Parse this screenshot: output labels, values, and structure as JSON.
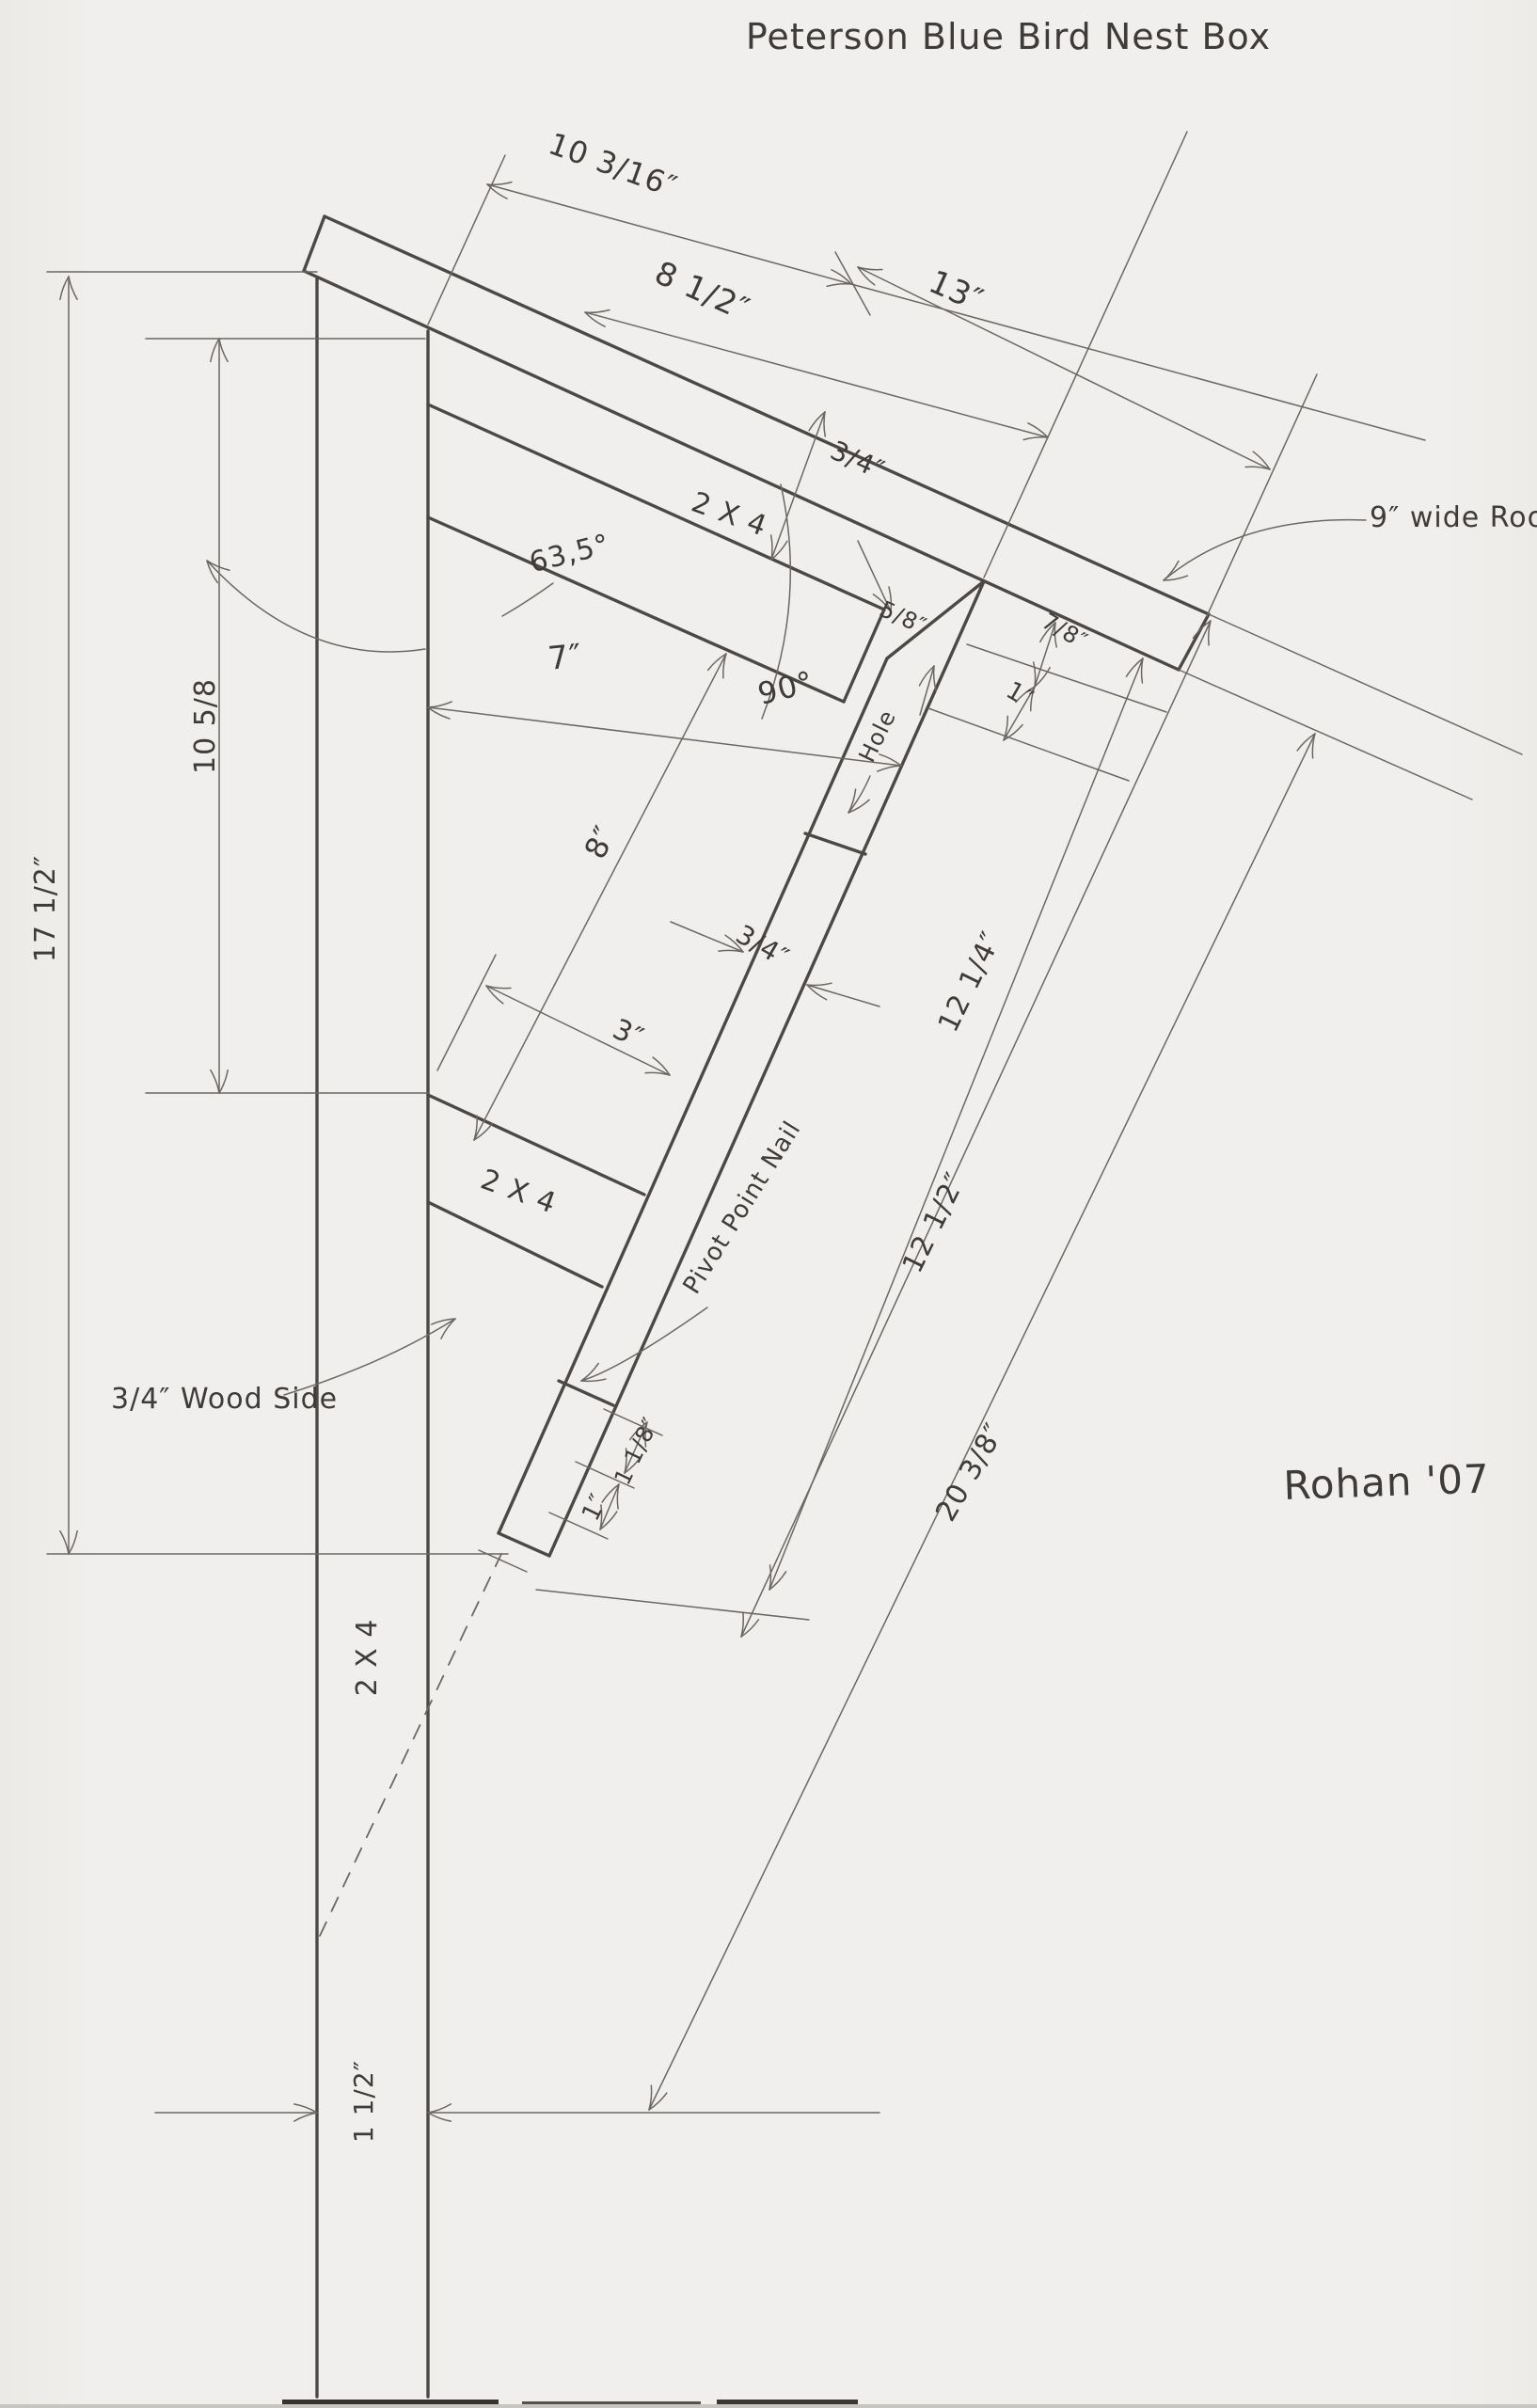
{
  "drawing": {
    "title": "Peterson Blue Bird Nest Box",
    "signature": "Rohan '07",
    "notes": {
      "roof_note": "9″ wide Roof",
      "side_note": "3/4″ Wood Side",
      "pivot_note": "Pivot Point Nail",
      "hole_label": "Hole"
    },
    "parts": {
      "roof_support_label": "2 X 4",
      "floor_block_label": "2 X 4",
      "post_label": "2 X 4"
    },
    "angles": {
      "roof_angle": "63,5°",
      "front_angle": "90°"
    },
    "dimensions": {
      "roof_overhang": "10 3/16″",
      "roof_upper": "8 1/2″",
      "roof_length": "13″",
      "roof_thickness": "3/4″",
      "notch": "5/8″",
      "inner_width": "7″",
      "gap_a": "7/8″",
      "gap_b": "1″",
      "post_upper": "10 5/8",
      "post_total": "17 1/2″",
      "front_upper": "8″",
      "front_thickness": "3/4″",
      "floor_span": "3″",
      "front_length": "12 1/4″",
      "door_length": "12 1/2″",
      "door_gap_a": "1 1/8″",
      "door_gap_b": "1″",
      "overall_diag": "20 3/8″",
      "post_width": "1 1/2″"
    },
    "colors": {
      "paper": "#f0eeec",
      "graphite_dark": "#4b4845",
      "graphite_light": "#6b6762",
      "text": "#3e3b38"
    }
  }
}
